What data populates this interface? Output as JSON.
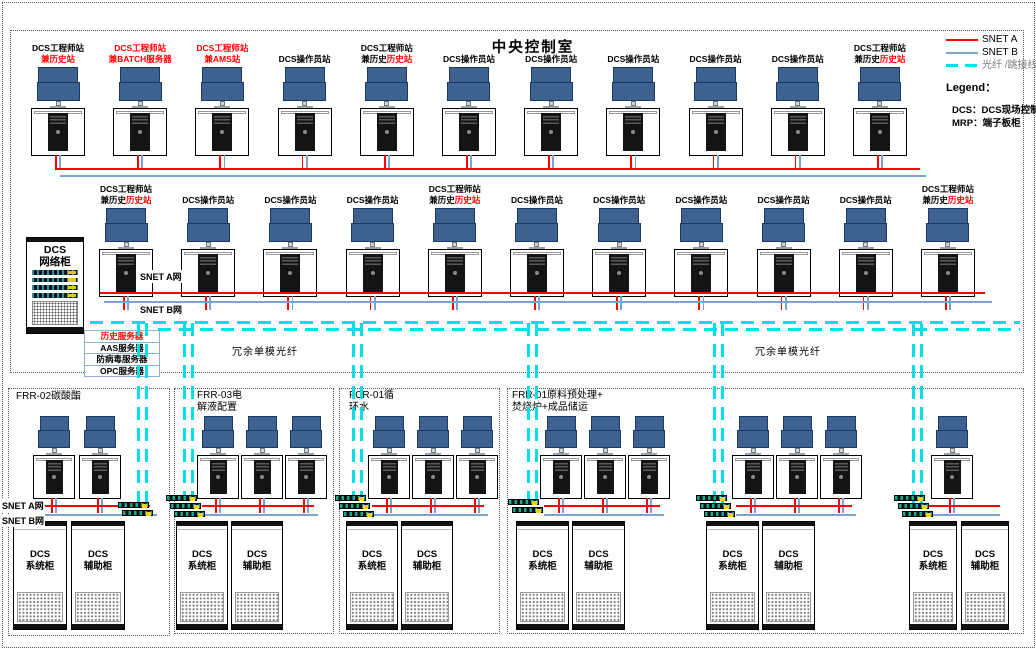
{
  "title": "中央控制室",
  "legend": {
    "snet_a": "SNET A",
    "snet_b": "SNET B",
    "fiber": "光纤 /跳接线",
    "heading": "Legend：",
    "dcs_def": "DCS：DCS现场控制",
    "mrp_def": "MRP：端子板柜"
  },
  "labels": {
    "snet_a_net": "SNET A网",
    "snet_b_net": "SNET B网"
  },
  "fiber_labels": {
    "left": "冗余单模光纤",
    "right": "冗余单模光纤"
  },
  "network_cabinet": {
    "lines": [
      "DCS",
      "网络柜"
    ]
  },
  "server_list": [
    {
      "text": "历史服务器",
      "red": true
    },
    {
      "text": "AAS服务器",
      "red": false
    },
    {
      "text": "防病毒服务器",
      "red": false
    },
    {
      "text": "OPC服务器",
      "red": false
    }
  ],
  "row1_stations": [
    {
      "line1": "DCS工程师站",
      "line1_red": false,
      "line2": [
        {
          "t": "兼历史站",
          "red": true
        }
      ]
    },
    {
      "line1": "DCS工程师站",
      "line1_red": true,
      "line2": [
        {
          "t": "兼BATCH服务器",
          "red": true
        }
      ]
    },
    {
      "line1": "DCS工程师站",
      "line1_red": true,
      "line2": [
        {
          "t": "兼AMS站",
          "red": true
        }
      ]
    },
    {
      "line1": "DCS操作员站"
    },
    {
      "line1": "DCS工程师站",
      "line1_red": false,
      "line2": [
        {
          "t": "兼历史",
          "red": false
        },
        {
          "t": "历史站",
          "red": true
        }
      ]
    },
    {
      "line1": "DCS操作员站"
    },
    {
      "line1": "DCS操作员站"
    },
    {
      "line1": "DCS操作员站"
    },
    {
      "line1": "DCS操作员站"
    },
    {
      "line1": "DCS操作员站"
    },
    {
      "line1": "DCS工程师站",
      "line1_red": false,
      "line2": [
        {
          "t": "兼历史",
          "red": false
        },
        {
          "t": "历史站",
          "red": true
        }
      ]
    }
  ],
  "row2_stations": [
    {
      "line1": "DCS工程师站",
      "line1_red": false,
      "line2": [
        {
          "t": "兼历史",
          "red": false
        },
        {
          "t": "历史站",
          "red": true
        }
      ]
    },
    {
      "line1": "DCS操作员站"
    },
    {
      "line1": "DCS操作员站"
    },
    {
      "line1": "DCS操作员站"
    },
    {
      "line1": "DCS工程师站",
      "line1_red": false,
      "line2": [
        {
          "t": "兼历史",
          "red": false
        },
        {
          "t": "历史站",
          "red": true
        }
      ]
    },
    {
      "line1": "DCS操作员站"
    },
    {
      "line1": "DCS操作员站"
    },
    {
      "line1": "DCS操作员站"
    },
    {
      "line1": "DCS操作员站"
    },
    {
      "line1": "DCS操作员站"
    },
    {
      "line1": "DCS工程师站",
      "line1_red": false,
      "line2": [
        {
          "t": "兼历史",
          "red": false
        },
        {
          "t": "历史站",
          "red": true
        }
      ]
    }
  ],
  "boxes": [
    {
      "title_lines": [
        "FRR-02碳酸酯"
      ],
      "clusters": [
        {
          "workstations": 2,
          "cabinets": [
            [
              "DCS",
              "系统柜"
            ],
            [
              "DCS",
              "辅助柜"
            ]
          ]
        }
      ]
    },
    {
      "title_lines": [
        "FRR-03电",
        "解液配置"
      ],
      "clusters": [
        {
          "workstations": 3,
          "cabinets": [
            [
              "DCS",
              "系统柜"
            ],
            [
              "DCS",
              "辅助柜"
            ]
          ]
        }
      ]
    },
    {
      "title_lines": [
        "FCR-01循",
        "环水"
      ],
      "clusters": [
        {
          "workstations": 3,
          "cabinets": [
            [
              "DCS",
              "系统柜"
            ],
            [
              "DCS",
              "辅助柜"
            ]
          ]
        }
      ]
    },
    {
      "title_lines": [
        "FRR-01原料预处理+",
        "焚烧炉+成品储运"
      ],
      "clusters": [
        {
          "workstations": 3,
          "cabinets": [
            [
              "DCS",
              "系统柜"
            ],
            [
              "DCS",
              "辅助柜"
            ]
          ]
        },
        {
          "workstations": 3,
          "cabinets": [
            [
              "DCS",
              "系统柜"
            ],
            [
              "DCS",
              "辅助柜"
            ]
          ]
        },
        {
          "workstations": 1,
          "cabinets": [
            [
              "DCS",
              "系统柜"
            ],
            [
              "DCS",
              "辅助柜"
            ]
          ]
        }
      ]
    }
  ],
  "colors": {
    "snet_a": "#ff0000",
    "snet_b": "#7aa3d4",
    "fiber": "#00e0e6",
    "monitor_fill": "#3d6190",
    "monitor_border": "#1b3a63",
    "red_text": "#ff0000"
  }
}
